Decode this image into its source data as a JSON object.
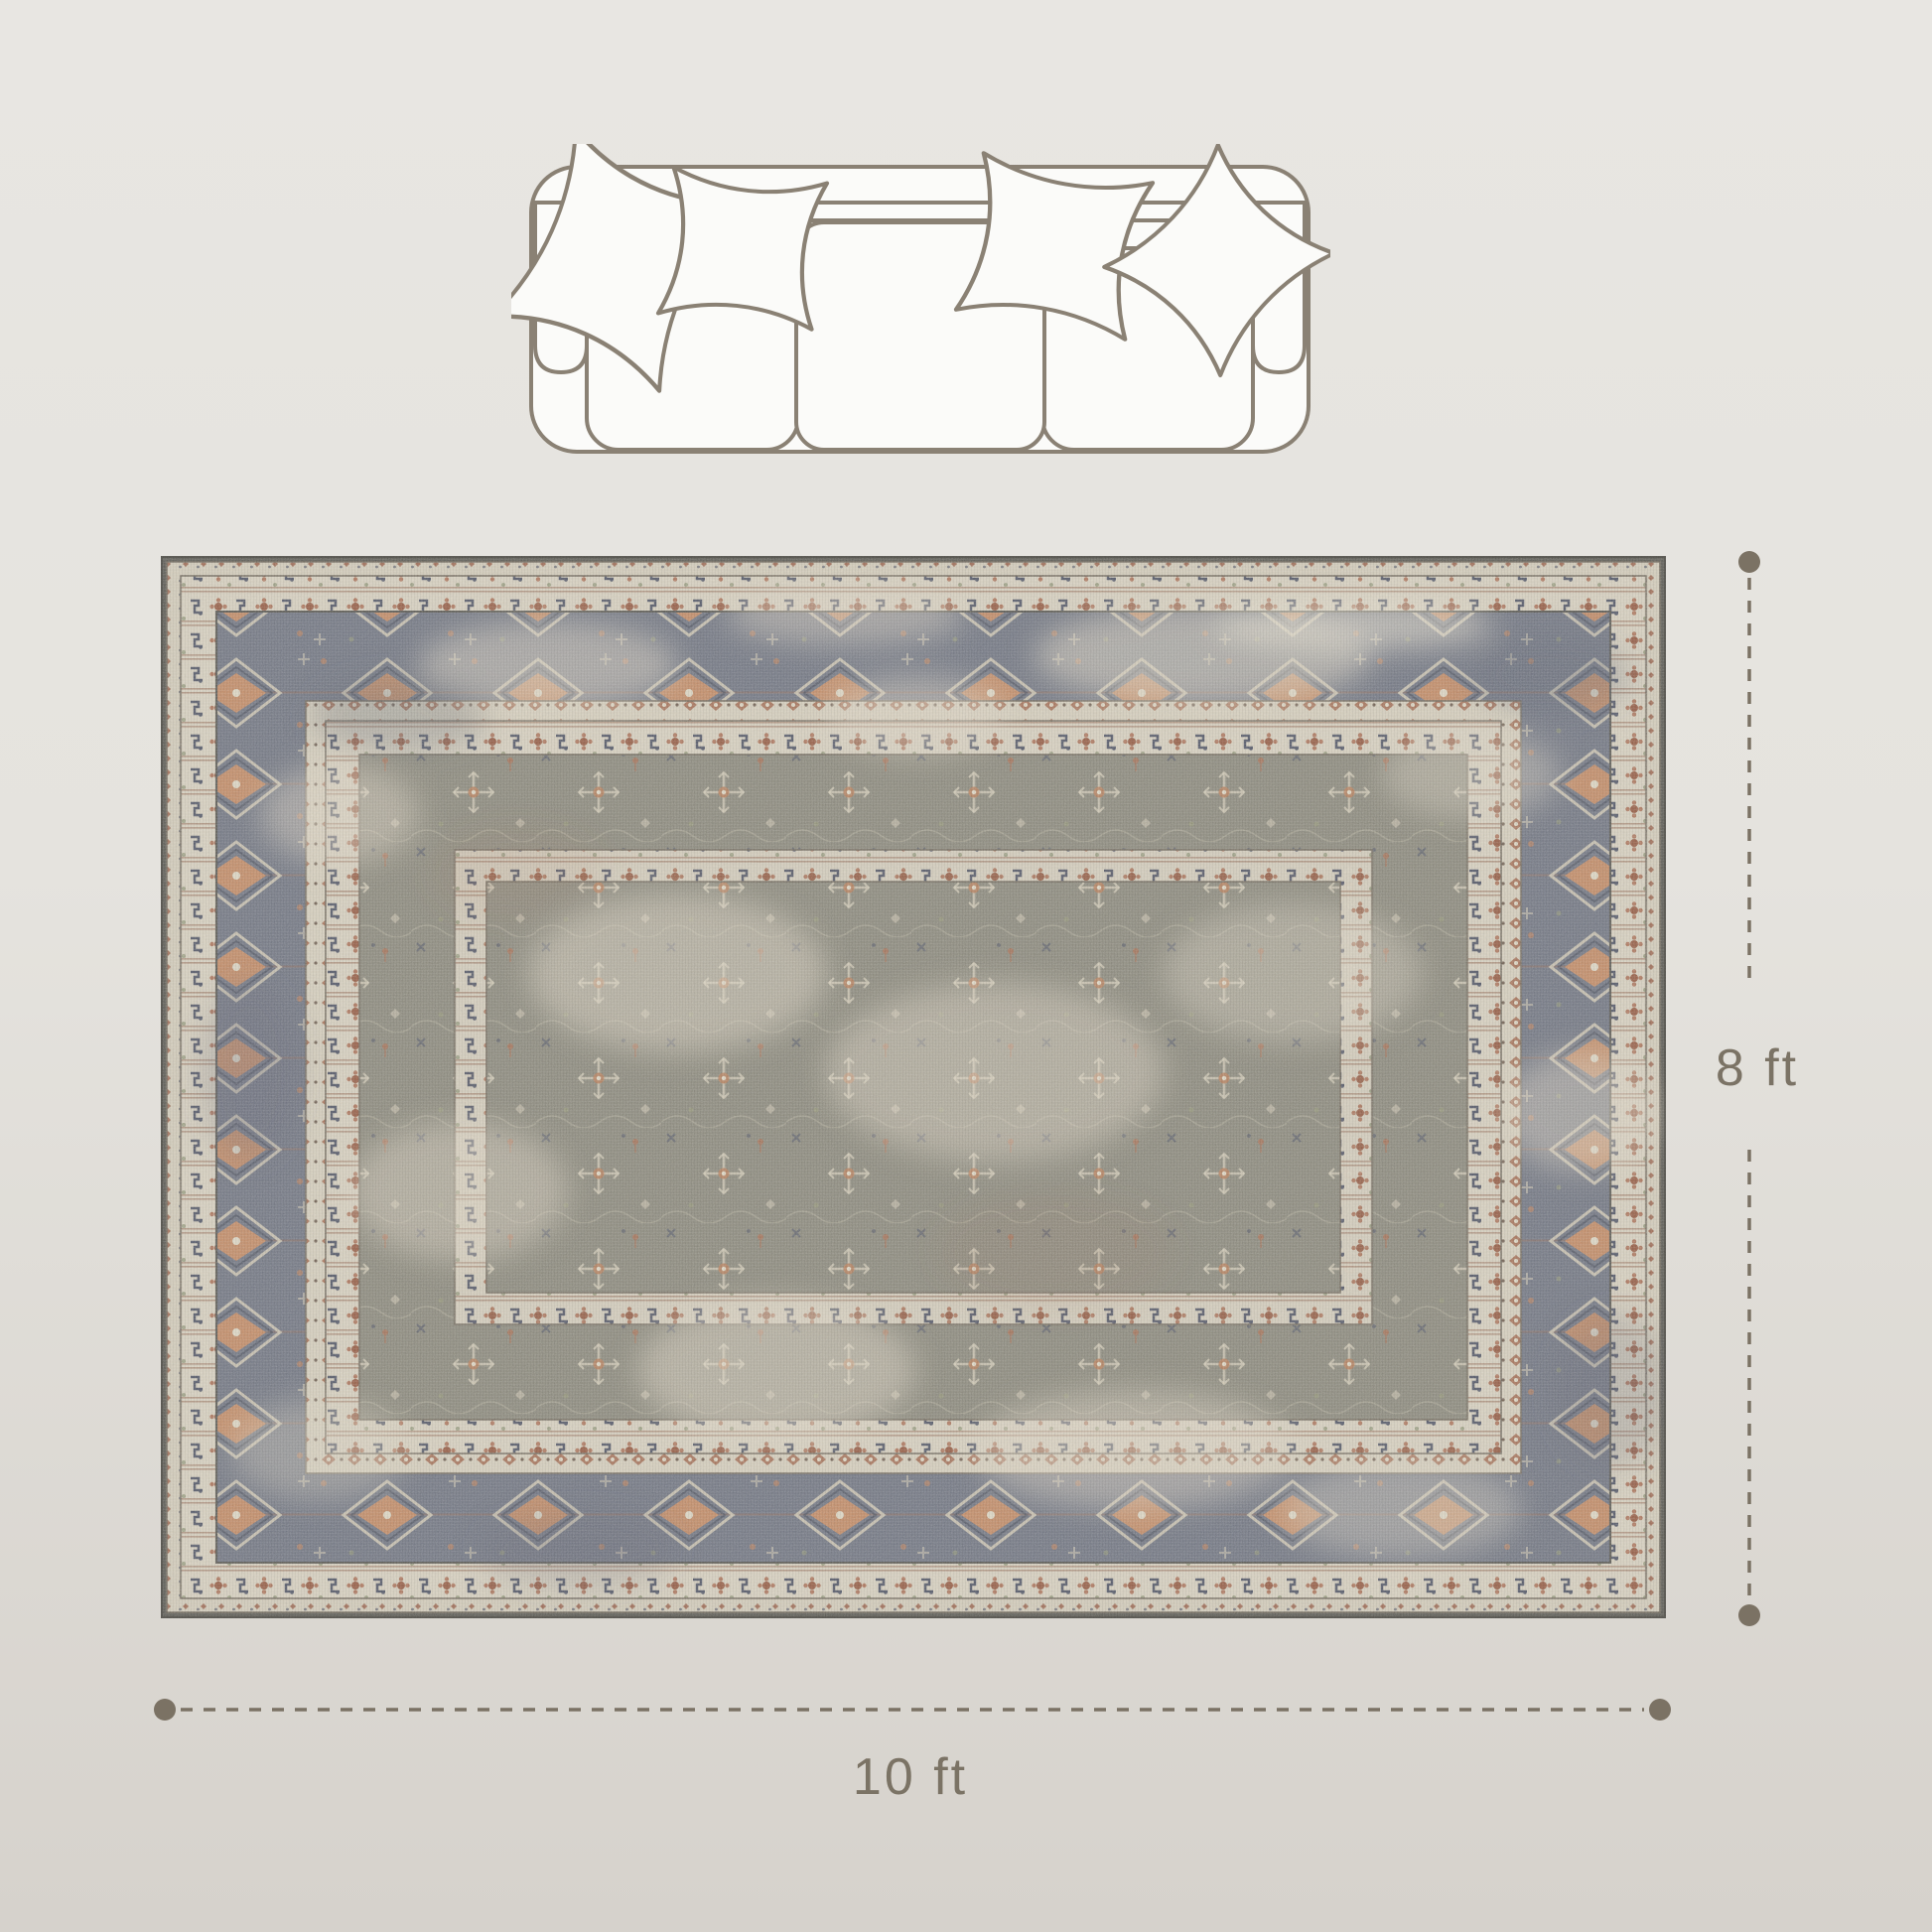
{
  "diagram": {
    "width_label": "10 ft",
    "height_label": "8 ft"
  },
  "sofa": {
    "seat_count": 3,
    "pillow_count": 4,
    "outline_color": "#8a8174",
    "fill_color": "#fbfbf9"
  },
  "rug": {
    "edge_color": "#57564f",
    "cream_color": "#d7d0bf",
    "rust_color": "#b57c58",
    "navy_color": "#4d5263",
    "border_band_color": "#6e7380",
    "field_color": "#89877a"
  },
  "dimension_lines": {
    "color": "#7b7264",
    "label_color": "#7b7365"
  },
  "background": {
    "top_color": "#e8e6e2",
    "bottom_color": "#d6d2cc"
  }
}
